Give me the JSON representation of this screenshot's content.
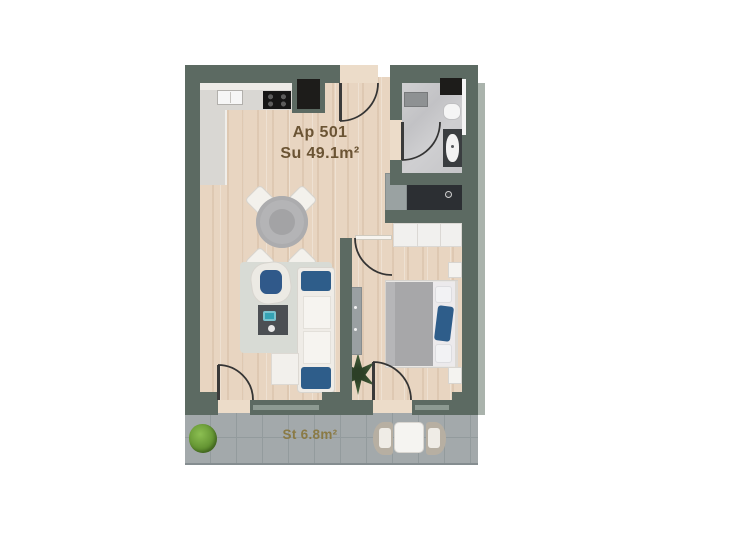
{
  "apartment": {
    "id_label": "Ap 501",
    "area_label": "Su 49.1m²"
  },
  "terrace": {
    "area_label": "St 6.8m²"
  },
  "colors": {
    "wall": "#5c6a62",
    "wood_floor": "#e8d5c1",
    "bath_floor": "#c9c9cb",
    "terrace_floor": "#a3a9ab",
    "accent_blue": "#2e5d8a",
    "apartment_label": "#6b5434",
    "terrace_label": "#8a7a45",
    "teal_accent": "#35a3b4",
    "bush_green": "#5a8a2b"
  },
  "rooms": [
    {
      "name": "kitchen-living-dining",
      "furniture": [
        "kitchen-counter",
        "sink",
        "stove",
        "dining-table",
        "dining-chairs-x4",
        "armchair",
        "coffee-table",
        "sofa",
        "chaise",
        "rug",
        "indoor-plant"
      ]
    },
    {
      "name": "bathroom",
      "furniture": [
        "shower-tray",
        "toilet",
        "vanity-sink",
        "laundry-closet"
      ]
    },
    {
      "name": "bedroom",
      "furniture": [
        "double-bed",
        "wardrobe",
        "dresser",
        "nightstand-x2"
      ]
    },
    {
      "name": "terrace",
      "furniture": [
        "bistro-table",
        "chair-x2",
        "bush"
      ]
    }
  ]
}
